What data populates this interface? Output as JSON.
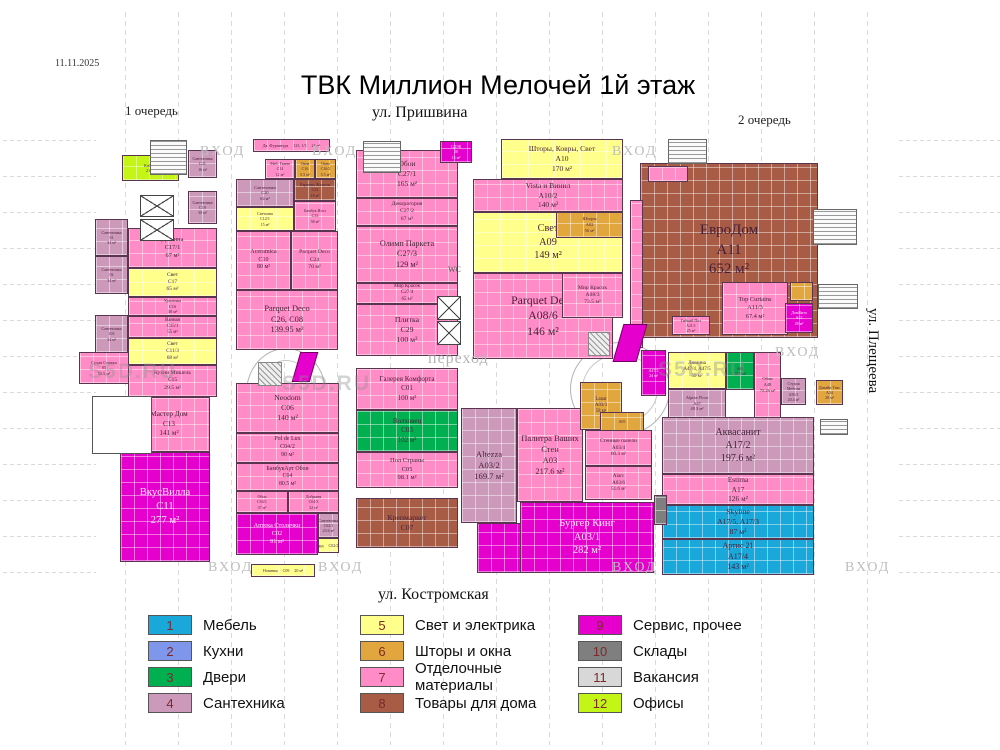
{
  "meta": {
    "date": "11.11.2025",
    "title": "ТВК Миллион Мелочей 1й этаж",
    "watermark": "S5D.RU"
  },
  "labels": {
    "phase1": "1 очередь",
    "phase2": "2 очередь",
    "street_top": "ул. Пришвина",
    "street_bottom": "ул. Костромская",
    "street_right": "ул. Плещеева",
    "entrance": "ВХОД",
    "passage": "переход",
    "wc": "WC"
  },
  "legend": [
    {
      "num": 1,
      "label": "Мебель",
      "color": "#1aa7d9"
    },
    {
      "num": 2,
      "label": "Кухни",
      "color": "#7e97ea"
    },
    {
      "num": 3,
      "label": "Двери",
      "color": "#00b050"
    },
    {
      "num": 4,
      "label": "Сантехника",
      "color": "#cc99bb"
    },
    {
      "num": 5,
      "label": "Свет и электрика",
      "color": "#ffff8c"
    },
    {
      "num": 6,
      "label": "Шторы и окна",
      "color": "#e2a63e"
    },
    {
      "num": 7,
      "label": "Отделочные материалы",
      "color": "#ff8cc6"
    },
    {
      "num": 8,
      "label": "Товары для дома",
      "color": "#a85b45"
    },
    {
      "num": 9,
      "label": "Сервис, прочее",
      "color": "#e600ce"
    },
    {
      "num": 10,
      "label": "Склады",
      "color": "#7f7f7f"
    },
    {
      "num": 11,
      "label": "Вакансия",
      "color": "#d8d8d8"
    },
    {
      "num": 12,
      "label": "Офисы",
      "color": "#c3f516"
    }
  ],
  "units": [
    {
      "name": "Каб. 51",
      "code": "",
      "area": "21 м²",
      "cat": 12,
      "x": 122,
      "y": 155,
      "w": 57,
      "h": 26
    },
    {
      "name": "Сантехника",
      "code": "01",
      "area": "34 м²",
      "cat": 4,
      "x": 95,
      "y": 219,
      "w": 33,
      "h": 37
    },
    {
      "name": "Сантехника",
      "code": "02",
      "area": "34 м²",
      "cat": 4,
      "x": 95,
      "y": 256,
      "w": 33,
      "h": 38
    },
    {
      "name": "Сантехника",
      "code": "103",
      "area": "34 м²",
      "cat": 4,
      "x": 95,
      "y": 315,
      "w": 33,
      "h": 38
    },
    {
      "name": "Сухая Стяжка",
      "code": "05",
      "area": "55.5 м²",
      "cat": 7,
      "x": 79,
      "y": 352,
      "w": 50,
      "h": 32
    },
    {
      "name": "Сантехника",
      "code": "C21",
      "area": "16 м²",
      "cat": 4,
      "x": 188,
      "y": 150,
      "w": 29,
      "h": 28
    },
    {
      "name": "Сантехника",
      "code": "C19",
      "area": "30 м²",
      "cat": 4,
      "x": 188,
      "y": 191,
      "w": 29,
      "h": 33
    },
    {
      "name": "Дижина",
      "code": "C17/1",
      "area": "67 м²",
      "cat": 7,
      "x": 128,
      "y": 228,
      "w": 89,
      "h": 40
    },
    {
      "name": "Свет",
      "code": "C17",
      "area": "65 м²",
      "cat": 5,
      "x": 128,
      "y": 268,
      "w": 89,
      "h": 29
    },
    {
      "name": "Уралочка",
      "code": "C16",
      "area": "30 м²",
      "cat": 7,
      "x": 128,
      "y": 297,
      "w": 89,
      "h": 19
    },
    {
      "name": "Ванная",
      "code": "C15/1",
      "area": "55 м²",
      "cat": 7,
      "x": 128,
      "y": 316,
      "w": 89,
      "h": 22
    },
    {
      "name": "Свет",
      "code": "C11/3",
      "area": "68 м²",
      "cat": 5,
      "x": 128,
      "y": 338,
      "w": 89,
      "h": 27
    },
    {
      "name": "Кухни Мишель",
      "code": "C15",
      "area": "29.5 м²",
      "cat": 7,
      "x": 128,
      "y": 365,
      "w": 89,
      "h": 32
    },
    {
      "name": "Мастер Дом",
      "code": "C13",
      "area": "141 м²",
      "cat": 7,
      "x": 128,
      "y": 397,
      "w": 82,
      "h": 55
    },
    {
      "name": "ВкусВилла",
      "code": "C11",
      "area": "277 м²",
      "cat": 9,
      "x": 120,
      "y": 452,
      "w": 90,
      "h": 110
    },
    {
      "name": "Дв. Фурнитура",
      "code": "123, 1/3",
      "area": "21 м²",
      "cat": 7,
      "x": 253,
      "y": 139,
      "w": 77,
      "h": 13
    },
    {
      "name": "Меб. Ткани",
      "code": "C14",
      "area": "12 м²",
      "cat": 7,
      "x": 265,
      "y": 159,
      "w": 30,
      "h": 20
    },
    {
      "name": "Окна",
      "code": "C16",
      "area": "5.5 м²",
      "cat": 6,
      "x": 295,
      "y": 159,
      "w": 20,
      "h": 20
    },
    {
      "name": "Окна",
      "code": "C16/2",
      "area": "5.5 м²",
      "cat": 6,
      "x": 315,
      "y": 159,
      "w": 21,
      "h": 20
    },
    {
      "name": "Сантехника",
      "code": "C20",
      "area": "64 м²",
      "cat": 4,
      "x": 236,
      "y": 179,
      "w": 58,
      "h": 28
    },
    {
      "name": "Карнизы Жалюзи",
      "code": "C22",
      "area": "18 м²",
      "cat": 8,
      "x": 294,
      "y": 179,
      "w": 42,
      "h": 22
    },
    {
      "name": "Светлана",
      "code": "C12/1",
      "area": "15 м²",
      "cat": 5,
      "x": 236,
      "y": 207,
      "w": 58,
      "h": 24
    },
    {
      "name": "Бамбук Изол",
      "code": "C33",
      "area": "58 м²",
      "cat": 7,
      "x": 294,
      "y": 201,
      "w": 42,
      "h": 30
    },
    {
      "name": "Aceramica",
      "code": "C10",
      "area": "80 м²",
      "cat": 7,
      "x": 236,
      "y": 231,
      "w": 55,
      "h": 59
    },
    {
      "name": "Parquet Deco",
      "code": "C24",
      "area": "70 м²",
      "cat": 7,
      "x": 291,
      "y": 231,
      "w": 47,
      "h": 59
    },
    {
      "name": "Parquet Deco",
      "code": "C26, C08",
      "area": "139.95 м²",
      "cat": 7,
      "x": 236,
      "y": 290,
      "w": 102,
      "h": 60
    },
    {
      "name": "Neodom",
      "code": "C06",
      "area": "140 м²",
      "cat": 7,
      "x": 236,
      "y": 383,
      "w": 103,
      "h": 50
    },
    {
      "name": "Pol de Lux",
      "code": "C04/2",
      "area": "90 м²",
      "cat": 7,
      "x": 236,
      "y": 433,
      "w": 103,
      "h": 30
    },
    {
      "name": "БамбукАрт Обои",
      "code": "C04",
      "area": "80.5 м²",
      "cat": 7,
      "x": 236,
      "y": 463,
      "w": 103,
      "h": 28
    },
    {
      "name": "Обои",
      "code": "C04/1",
      "area": "37 м²",
      "cat": 7,
      "x": 236,
      "y": 491,
      "w": 52,
      "h": 22
    },
    {
      "name": "Добрыня",
      "code": "C04/3",
      "area": "32 м²",
      "cat": 7,
      "x": 288,
      "y": 491,
      "w": 51,
      "h": 22
    },
    {
      "name": "Аптека Столички",
      "code": "C02",
      "area": "91 м²",
      "cat": 9,
      "x": 236,
      "y": 513,
      "w": 82,
      "h": 42
    },
    {
      "name": "Сантехника",
      "code": "C02/1",
      "area": "23.6 м²",
      "cat": 4,
      "x": 318,
      "y": 513,
      "w": 21,
      "h": 25
    },
    {
      "name": "Ломбард",
      "code": "C02/2",
      "area": "7.6 м²",
      "cat": 5,
      "x": 318,
      "y": 538,
      "w": 21,
      "h": 15
    },
    {
      "name": "Новинка",
      "code": "C09",
      "area": "20 м²",
      "cat": 5,
      "x": 251,
      "y": 564,
      "w": 64,
      "h": 13
    },
    {
      "name": "Обои",
      "code": "C27/1",
      "area": "165 м²",
      "cat": 7,
      "x": 356,
      "y": 150,
      "w": 102,
      "h": 48
    },
    {
      "name": "Декоратория",
      "code": "C27/2",
      "area": "67 м²",
      "cat": 7,
      "x": 356,
      "y": 198,
      "w": 102,
      "h": 28
    },
    {
      "name": "Олимп Паркета",
      "code": "C27/3",
      "area": "129 м²",
      "cat": 7,
      "x": 356,
      "y": 226,
      "w": 102,
      "h": 57
    },
    {
      "name": "Мир Красок",
      "code": "C27/4",
      "area": "65 м²",
      "cat": 7,
      "x": 356,
      "y": 283,
      "w": 102,
      "h": 21
    },
    {
      "name": "Плитка",
      "code": "C29",
      "area": "100 м²",
      "cat": 7,
      "x": 356,
      "y": 304,
      "w": 102,
      "h": 52
    },
    {
      "name": "Галерея Комфорта",
      "code": "C01",
      "area": "100 м²",
      "cat": 7,
      "x": 356,
      "y": 368,
      "w": 102,
      "h": 42
    },
    {
      "name": "Волховец",
      "code": "C03",
      "area": "102 м²",
      "cat": 3,
      "x": 356,
      "y": 410,
      "w": 102,
      "h": 42
    },
    {
      "name": "Пол Страны",
      "code": "C05",
      "area": "98.1 м²",
      "cat": 7,
      "x": 356,
      "y": 452,
      "w": 102,
      "h": 36
    },
    {
      "name": "Крепмаркет",
      "code": "C07",
      "area": "",
      "cat": 8,
      "x": 356,
      "y": 498,
      "w": 102,
      "h": 50
    },
    {
      "name": "СДЭК",
      "code": "20",
      "area": "15 м²",
      "cat": 9,
      "x": 440,
      "y": 141,
      "w": 32,
      "h": 22
    },
    {
      "name": "",
      "code": "",
      "area": "",
      "cat": 8,
      "x": 505,
      "y": 293,
      "w": 17,
      "h": 45
    },
    {
      "name": "Шторы, Ковры, Свет",
      "code": "A10",
      "area": "170 м²",
      "cat": 5,
      "x": 501,
      "y": 139,
      "w": 122,
      "h": 40
    },
    {
      "name": "Vista и Винил",
      "code": "A10/2",
      "area": "140 м²",
      "cat": 7,
      "x": 473,
      "y": 179,
      "w": 150,
      "h": 33
    },
    {
      "name": "Свет",
      "code": "A09",
      "area": "149 м²",
      "cat": 5,
      "x": 473,
      "y": 212,
      "w": 150,
      "h": 61
    },
    {
      "name": "Шторы",
      "code": "A02",
      "area": "56 м²",
      "cat": 6,
      "x": 556,
      "y": 212,
      "w": 67,
      "h": 26
    },
    {
      "name": "Parquet Deco",
      "code": "A08/6",
      "area": "146 м²",
      "cat": 7,
      "x": 473,
      "y": 273,
      "w": 140,
      "h": 86
    },
    {
      "name": "Мир Красок",
      "code": "A08/3",
      "area": "73.5 м²",
      "cat": 7,
      "x": 562,
      "y": 273,
      "w": 61,
      "h": 45
    },
    {
      "name": "ЕвроДом",
      "code": "A11",
      "area": "652 м²",
      "cat": 8,
      "x": 640,
      "y": 163,
      "w": 178,
      "h": 175
    },
    {
      "name": "",
      "code": "",
      "area": "",
      "cat": 7,
      "x": 630,
      "y": 200,
      "w": 13,
      "h": 148
    },
    {
      "name": "",
      "code": "",
      "area": "",
      "cat": 7,
      "x": 648,
      "y": 166,
      "w": 40,
      "h": 16
    },
    {
      "name": "Гибкий Пол",
      "code": "A11/1",
      "area": "25 м²",
      "cat": 7,
      "x": 672,
      "y": 316,
      "w": 38,
      "h": 19
    },
    {
      "name": "Top Curtains",
      "code": "A11/3",
      "area": "67.4 м²",
      "cat": 7,
      "x": 722,
      "y": 282,
      "w": 66,
      "h": 53
    },
    {
      "name": "",
      "code": "",
      "area": "",
      "cat": 6,
      "x": 790,
      "y": 282,
      "w": 23,
      "h": 19
    },
    {
      "name": "ДомВита",
      "code": "A33",
      "area": "28 м²",
      "cat": 9,
      "x": 785,
      "y": 303,
      "w": 28,
      "h": 30
    },
    {
      "name": "",
      "code": "A47/2",
      "area": "24 м²",
      "cat": 9,
      "x": 641,
      "y": 350,
      "w": 25,
      "h": 46
    },
    {
      "name": "Люмина",
      "code": "A47/4, A47/5",
      "area": "59 м²",
      "cat": 5,
      "x": 668,
      "y": 352,
      "w": 58,
      "h": 37
    },
    {
      "name": "",
      "code": "A46",
      "area": "30.5 м²",
      "cat": 3,
      "x": 726,
      "y": 352,
      "w": 28,
      "h": 38
    },
    {
      "name": "Обои",
      "code": "A48",
      "area": "75.26 м²",
      "cat": 7,
      "x": 754,
      "y": 352,
      "w": 27,
      "h": 66
    },
    {
      "name": "Alpine Floor",
      "code": "A47",
      "area": "49.3 м²",
      "cat": 4,
      "x": 668,
      "y": 389,
      "w": 58,
      "h": 29
    },
    {
      "name": "Студия Мебели",
      "code": "A50/1",
      "area": "20.4 м²",
      "cat": 4,
      "x": 781,
      "y": 378,
      "w": 25,
      "h": 27
    },
    {
      "name": "Дизайн Текс",
      "code": "A34",
      "area": "28 м²",
      "cat": 6,
      "x": 816,
      "y": 380,
      "w": 27,
      "h": 25
    },
    {
      "name": "",
      "code": "",
      "area": "19.8 м²",
      "cat": 9,
      "x": 790,
      "y": 420,
      "w": 24,
      "h": 19
    },
    {
      "name": "Аквасанит",
      "code": "A17/2",
      "area": "197.6 м²",
      "cat": 4,
      "x": 662,
      "y": 417,
      "w": 152,
      "h": 57
    },
    {
      "name": "Estima",
      "code": "A17",
      "area": "126 м²",
      "cat": 7,
      "x": 662,
      "y": 474,
      "w": 152,
      "h": 31
    },
    {
      "name": "Skyline",
      "code": "A17/5, A17/3",
      "area": "87 м²",
      "cat": 1,
      "x": 662,
      "y": 505,
      "w": 152,
      "h": 34
    },
    {
      "name": "Артис 21",
      "code": "A17/4",
      "area": "143 м²",
      "cat": 1,
      "x": 662,
      "y": 539,
      "w": 152,
      "h": 36
    },
    {
      "name": "Altezza",
      "code": "A03/2",
      "area": "169.7 м²",
      "cat": 4,
      "x": 461,
      "y": 408,
      "w": 56,
      "h": 115
    },
    {
      "name": "Палитра Ваших Стен",
      "code": "A03",
      "area": "217.6 м²",
      "cat": 7,
      "x": 517,
      "y": 408,
      "w": 66,
      "h": 94
    },
    {
      "name": "Lanat",
      "code": "A03/3",
      "area": "58 м²",
      "cat": 6,
      "x": 580,
      "y": 382,
      "w": 42,
      "h": 48
    },
    {
      "name": "",
      "code": "A05",
      "area": "",
      "cat": 6,
      "x": 600,
      "y": 412,
      "w": 44,
      "h": 20
    },
    {
      "name": "Стенные панели",
      "code": "A03/4",
      "area": "60.3 м²",
      "cat": 7,
      "x": 585,
      "y": 430,
      "w": 67,
      "h": 36
    },
    {
      "name": "Alarc",
      "code": "A03/6",
      "area": "51.6 м²",
      "cat": 7,
      "x": 585,
      "y": 466,
      "w": 67,
      "h": 34
    },
    {
      "name": "Бургер Кинг",
      "code": "A03/1",
      "area": "282 м²",
      "cat": 9,
      "x": 520,
      "y": 502,
      "w": 134,
      "h": 71
    },
    {
      "name": "",
      "code": "",
      "area": "",
      "cat": 9,
      "x": 477,
      "y": 523,
      "w": 44,
      "h": 50
    },
    {
      "name": "",
      "code": "",
      "area": "",
      "cat": 10,
      "x": 654,
      "y": 495,
      "w": 13,
      "h": 30
    }
  ]
}
